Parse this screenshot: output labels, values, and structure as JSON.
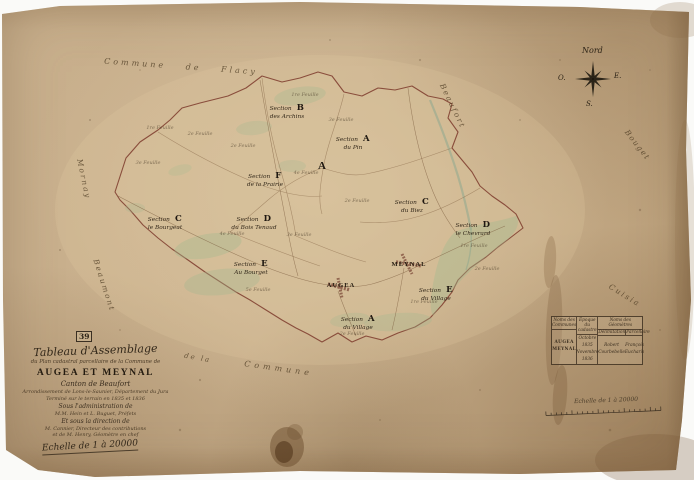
{
  "document_type": "Scanned cadastral assembly map (tableau d'assemblage)",
  "plate": {
    "number": "39"
  },
  "title_block": {
    "line1": "Tableau d'Assemblage",
    "line2": "du Plan cadastral parcellaire de la Commune de",
    "commune": "AUGEA ET MEYNAL",
    "canton": "Canton de Beaufort",
    "arrondissement": "Arrondissement de Lons-le-Saunier, Département du Jura",
    "survey": "Terminé sur le terrain en 1835 et 1836",
    "admin_intro": "Sous l'administration de",
    "admin_names": "M.M. Hein et L. Buguet, Préfets",
    "dir_intro": "Et sous la direction de",
    "dir_line1": "M. Cannier, Directeur des contributions",
    "dir_line2": "et de M. Henry, Géomètre en chef"
  },
  "scale_main": "Echelle de 1 à 20000",
  "scale_bar_label": "Echelle de 1 à 20000",
  "compass": {
    "north": "Nord",
    "east": "E.",
    "west": "O.",
    "south": "S."
  },
  "places": [
    {
      "name": "MEYNAL"
    },
    {
      "name": "AUGEA"
    }
  ],
  "map_mark": "A",
  "sections": [
    {
      "prefix": "Section",
      "letter": "B",
      "name": "des Archins"
    },
    {
      "prefix": "Section",
      "letter": "A",
      "name": "du Pin"
    },
    {
      "prefix": "Section",
      "letter": "C",
      "name": "du Biez"
    },
    {
      "prefix": "Section",
      "letter": "D",
      "name": "le Chevrard"
    },
    {
      "prefix": "Section",
      "letter": "C",
      "name": "le Bourgeat"
    },
    {
      "prefix": "Section",
      "letter": "D",
      "name": "du Bois Tenaud"
    },
    {
      "prefix": "Section",
      "letter": "F",
      "name": "de la Prairie"
    },
    {
      "prefix": "Section",
      "letter": "E",
      "name": "Au Bourget"
    },
    {
      "prefix": "Section",
      "letter": "E",
      "name": "du Village"
    },
    {
      "prefix": "Section",
      "letter": "A",
      "name": "du Village"
    }
  ],
  "feuilles": [
    {
      "t": "1re Feuille"
    },
    {
      "t": "2e Feuille"
    },
    {
      "t": "3e Feuille"
    },
    {
      "t": "2e Feuille"
    },
    {
      "t": "1re Feuille"
    },
    {
      "t": "3e Feuille"
    },
    {
      "t": "4e Feuille"
    },
    {
      "t": "4e Feuille"
    },
    {
      "t": "3e Feuille"
    },
    {
      "t": "2e Feuille"
    },
    {
      "t": "1re Feuille"
    },
    {
      "t": "2e Feuille"
    },
    {
      "t": "1re Feuille"
    },
    {
      "t": "2e Feuille"
    },
    {
      "t": "5e Feuille"
    }
  ],
  "neighbors": [
    {
      "t": "Commune  de  Flacy"
    },
    {
      "t": "Beaufort"
    },
    {
      "t": "Bouget"
    },
    {
      "t": "Cuisia"
    },
    {
      "t": "Mornay"
    },
    {
      "t": "Beaumont"
    },
    {
      "t": "de la"
    },
    {
      "t": "Commune"
    }
  ],
  "legend_table": {
    "c1_header": "Noms des Communes",
    "c2_header": "Époque du cadastre",
    "c3_header": "Noms des Géomètres",
    "c3a_sub": "Délimitation",
    "c3b_sub": "Parcellaire",
    "row_commune_1": "AUGEA",
    "row_commune_2": "MEYNAL",
    "row_epoque_1": "Octobre 1835",
    "row_epoque_2": "Novembre 1836",
    "row_geo_a1": "Robert",
    "row_geo_a2": "Courbebelle",
    "row_geo_b1": "François",
    "row_geo_b2": "Eucharis"
  },
  "colors": {
    "paper": "#c7ae8b",
    "boundary": "#7c392b",
    "ink": "#3b2e1f",
    "meadow_green": "#a3b88e"
  }
}
